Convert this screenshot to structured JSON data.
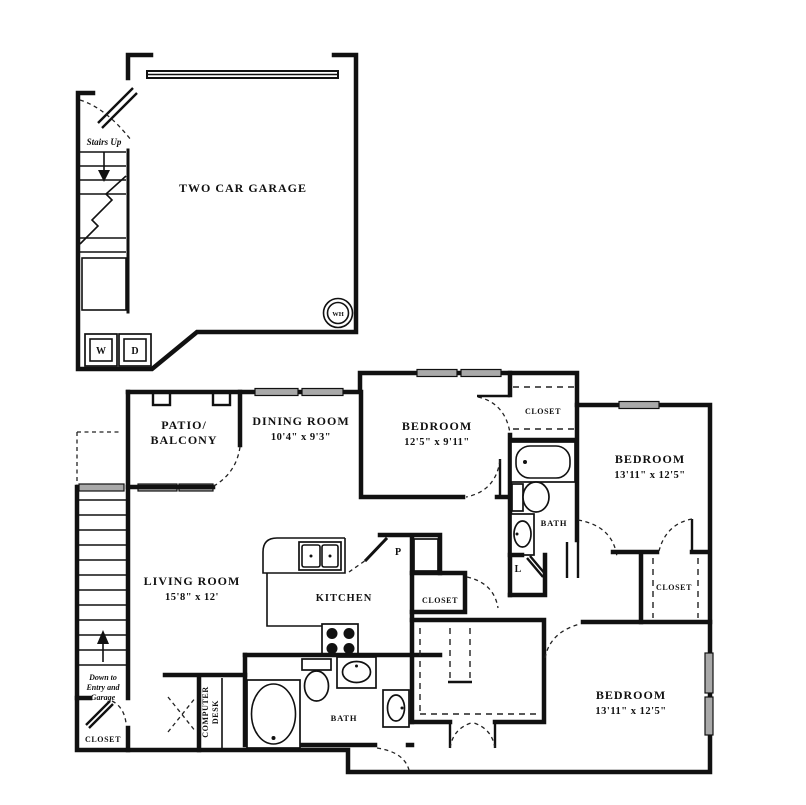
{
  "plan": {
    "garage": {
      "name": "TWO CAR GARAGE"
    },
    "patio": {
      "line1": "PATIO/",
      "line2": "BALCONY"
    },
    "dining": {
      "name": "DINING ROOM",
      "dims": "10'4\" x 9'3\""
    },
    "bedroom1": {
      "name": "BEDROOM",
      "dims": "12'5\" x 9'11\""
    },
    "bedroom2": {
      "name": "BEDROOM",
      "dims": "13'11\" x 12'5\""
    },
    "bedroom3": {
      "name": "BEDROOM",
      "dims": "13'11\" x 12'5\""
    },
    "living": {
      "name": "LIVING ROOM",
      "dims": "15'8\" x 12'"
    },
    "kitchen": {
      "name": "KITCHEN"
    },
    "bath_upper": {
      "name": "BATH"
    },
    "bath_lower": {
      "name": "BATH"
    },
    "closet_top": "CLOSET",
    "closet_right": "CLOSET",
    "closet_hall": "CLOSET",
    "closet_under_stairs": "CLOSET",
    "linen": "L",
    "pantry": "P",
    "washer": "W",
    "dryer": "D",
    "water_heater": "WH",
    "stairs_up": "Stairs Up",
    "down_line1": "Down to",
    "down_line2": "Entry and",
    "down_line3": "Garage",
    "desk_line1": "COMPUTER",
    "desk_line2": "DESK"
  }
}
